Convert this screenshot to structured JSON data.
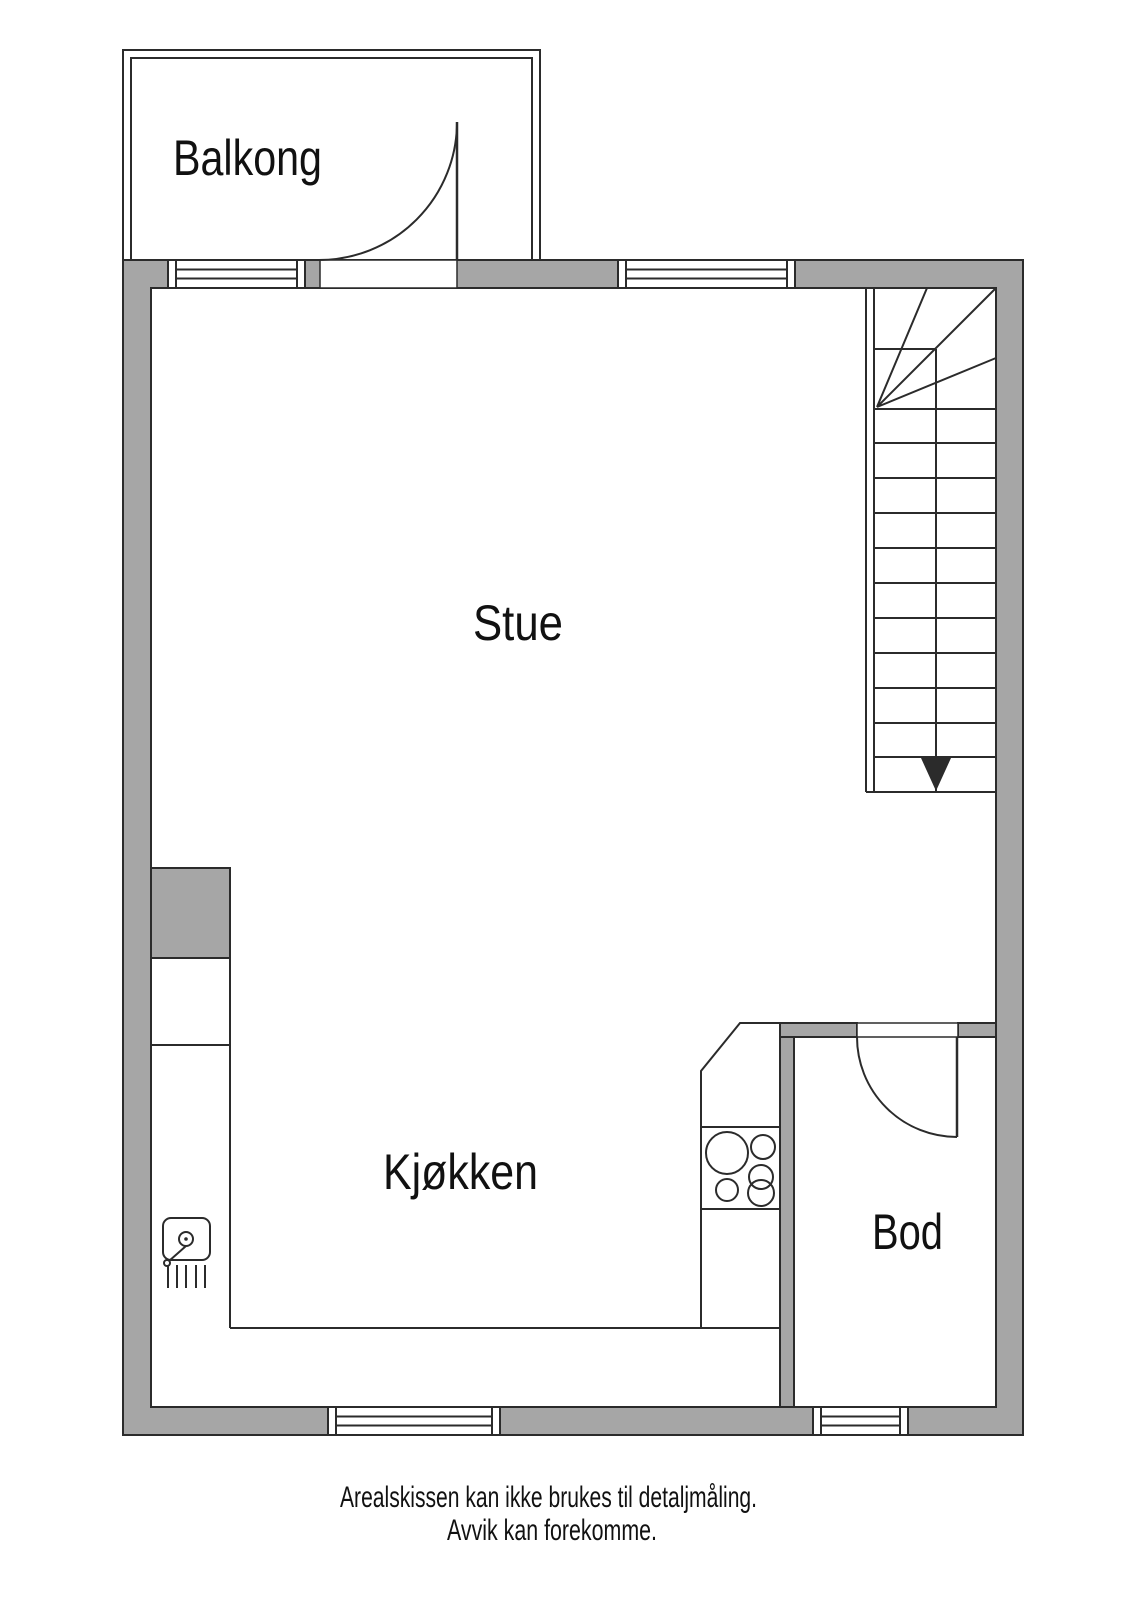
{
  "floorplan": {
    "rooms": [
      {
        "label": "Balkong"
      },
      {
        "label": "Stue"
      },
      {
        "label": "Kjøkken"
      },
      {
        "label": "Bod"
      }
    ],
    "fixtures": [
      {
        "name": "staircase-with-down-arrow"
      },
      {
        "name": "balcony-door-swing"
      },
      {
        "name": "bod-door-swing"
      },
      {
        "name": "kitchen-sink"
      },
      {
        "name": "stove-burners"
      },
      {
        "name": "window-balcony"
      },
      {
        "name": "window-stue"
      },
      {
        "name": "window-kitchen"
      },
      {
        "name": "window-bod"
      }
    ],
    "disclaimer": {
      "line1": "Arealskissen kan ikke brukes til detaljmåling.",
      "line2": "Avvik kan forekomme."
    },
    "colors": {
      "wall_fill": "#a6a6a6",
      "line": "#2b2b2b",
      "text_color": "#111111",
      "background": "#ffffff"
    }
  }
}
